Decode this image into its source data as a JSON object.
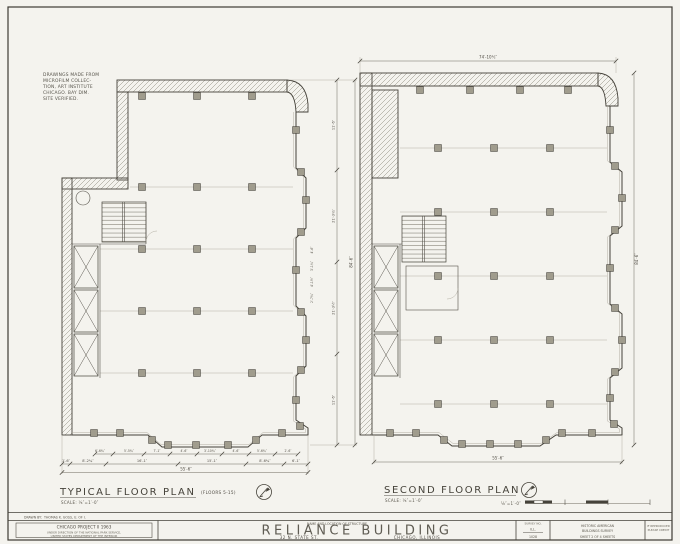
{
  "sheet": {
    "note_lines": [
      "DRAWINGS MADE FROM",
      "MICROFILM COLLEC-",
      "TION, ART INSTITUTE",
      "CHICAGO. BAY DIM.",
      "SITE VERIFIED."
    ],
    "typical_plan": {
      "title": "TYPICAL FLOOR PLAN",
      "floors": "(FLOORS 5-15)",
      "scale_label": "SCALE: ⅛″=1′-0″",
      "dims": {
        "overall_bottom": "55′-6″",
        "overall_right": "84′-6″",
        "bottom_row": [
          "1′-6″",
          "8′-2¾″",
          "16′-1″",
          "15′-1″",
          "8′-6¾″",
          "6′-1″"
        ],
        "bottom_small": [
          "6′-6¾″",
          "5′-5¾″",
          "7′-1″",
          "4′-6″",
          "3′-10¾″",
          "4′-6″",
          "5′-6¾″",
          "2′-6″"
        ],
        "right_row": [
          "11′-6″",
          "21′-3¾″",
          "21′-3½″",
          "11′-6″"
        ],
        "bay_dims": [
          "4′-6″",
          "3′-1¾″",
          "4′-1½″",
          "2′-7¾″"
        ]
      }
    },
    "second_plan": {
      "title": "SECOND FLOOR PLAN",
      "scale_label": "SCALE: ⅛″=1′-0″",
      "dims": {
        "top": "74′-10½″",
        "right": "84′-6″",
        "bottom": "55′-6″"
      }
    },
    "graphic_scale": {
      "label": "⅛″=1′-0″"
    },
    "title_block": {
      "drawn_by_label": "DRAWN BY:",
      "drawn_by_value": "THOMAS K. GOSS, U. OF I.",
      "project_line1": "CHICAGO PROJECT II 1963",
      "project_line2": "UNDER DIRECTION OF THE NATIONAL PARK SERVICE,",
      "project_line3": "UNITED STATES DEPARTMENT OF THE INTERIOR",
      "name_header": "NAME AND LOCATION OF STRUCTURE",
      "building_name": "RELIANCE BUILDING",
      "address": "32 N. STATE ST.",
      "city": "CHICAGO, ILLINOIS",
      "survey_header": "SURVEY NO.",
      "survey_line1": "ILL.",
      "survey_line2": "1028",
      "habs_line1": "HISTORIC AMERICAN",
      "habs_line2": "BUILDINGS SURVEY",
      "sheet_line": "SHEET 2 OF 4 SHEETS",
      "credit_line1": "IF REPRODUCED",
      "credit_line2": "PLEASE CREDIT"
    },
    "colors": {
      "ink": "#45423a",
      "paper": "#f4f3ee"
    }
  }
}
